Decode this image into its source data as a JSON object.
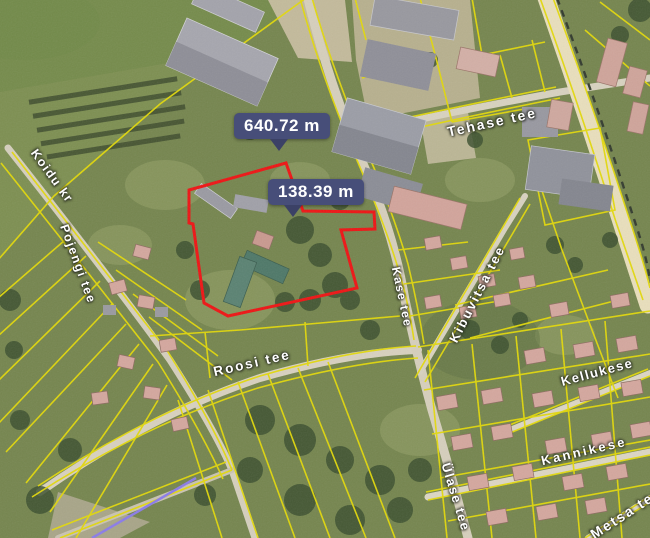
{
  "map": {
    "measurements": [
      {
        "label": "640.72 m"
      },
      {
        "label": "138.39 m"
      }
    ],
    "streets": [
      {
        "name": "Koidu kr"
      },
      {
        "name": "Pojengi tee"
      },
      {
        "name": "Tehase tee"
      },
      {
        "name": "Kase tee"
      },
      {
        "name": "Roosi tee"
      },
      {
        "name": "Kibuvitsa tee"
      },
      {
        "name": "Kellukese"
      },
      {
        "name": "Kannikese"
      },
      {
        "name": "Ülase tee"
      },
      {
        "name": "Metsa tee"
      }
    ],
    "colors": {
      "terrain": "#75854e",
      "cadastral_line": "#e3d909",
      "selected_parcel": "#ee1414",
      "badge_bg": "#474e79",
      "badge_pointer": "#3b4166",
      "badge_text": "#ffffff",
      "street_label": "#ffffff",
      "road": "#d8d1bf",
      "highway": "#e9dfbc",
      "route_line": "#8b7ce8"
    }
  }
}
